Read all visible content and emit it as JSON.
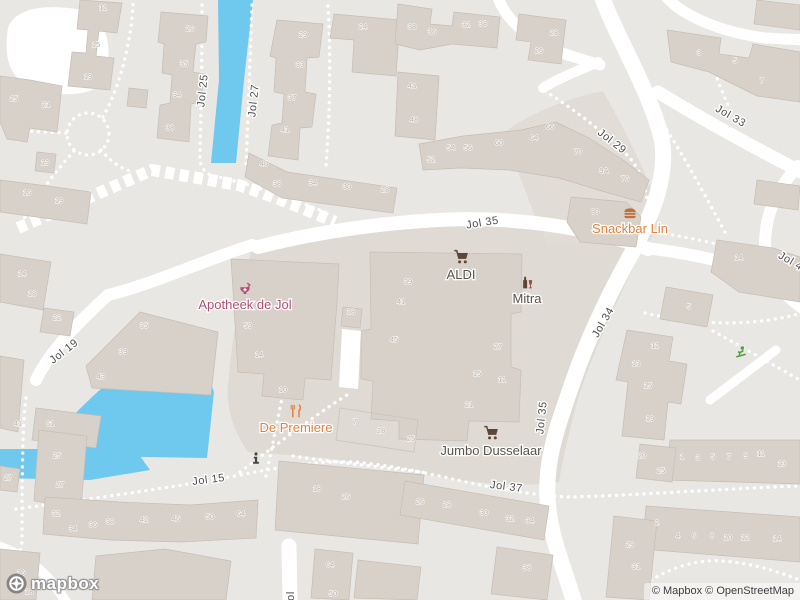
{
  "map": {
    "colors": {
      "land": "#e9e7e4",
      "paved_zone": "#dfdbd4",
      "building": "#d8d1c9",
      "water": "#6fc8ee",
      "road": "#ffffff",
      "street_label": "#4c4c4c",
      "house_number": "#b1aba3",
      "poi_orange": "#e0813e",
      "poi_maroon": "#b04f73",
      "poi_dark": "#58524d",
      "poi_brown": "#6d4b38",
      "playground_green": "#4ba13e"
    },
    "street_labels": [
      {
        "text": "Jol 25",
        "x": 206,
        "y": 91,
        "rotate": -84
      },
      {
        "text": "Jol 27",
        "x": 257,
        "y": 101,
        "rotate": -84
      },
      {
        "text": "Jol 29",
        "x": 610,
        "y": 144,
        "rotate": 38
      },
      {
        "text": "Jol 33",
        "x": 729,
        "y": 119,
        "rotate": 30
      },
      {
        "text": "Jol 35",
        "x": 483,
        "y": 226,
        "rotate": -9
      },
      {
        "text": "Jol 4",
        "x": 789,
        "y": 264,
        "rotate": 30
      },
      {
        "text": "Jol 34",
        "x": 606,
        "y": 324,
        "rotate": -60
      },
      {
        "text": "Jol 19",
        "x": 66,
        "y": 354,
        "rotate": -38
      },
      {
        "text": "Jol 35",
        "x": 545,
        "y": 418,
        "rotate": -84
      },
      {
        "text": "Jol 15",
        "x": 209,
        "y": 483,
        "rotate": -7
      },
      {
        "text": "Jol 37",
        "x": 506,
        "y": 490,
        "rotate": 7
      },
      {
        "text": "Jol",
        "x": 294,
        "y": 599,
        "rotate": -90
      }
    ],
    "pois": [
      {
        "label": "Apotheek de Jol",
        "icon": "pharmacy-icon",
        "x": 245,
        "y": 289,
        "label_y": 309,
        "color": "#b04f73",
        "size": 14
      },
      {
        "label": "Snackbar Lin",
        "icon": "burger-icon",
        "x": 630,
        "y": 213,
        "label_y": 233,
        "color": "#e0813e",
        "icon_color": "#c0703a",
        "size": 15
      },
      {
        "label": "ALDI",
        "icon": "cart-icon",
        "x": 461,
        "y": 257,
        "label_y": 279,
        "color": "#58524d",
        "icon_color": "#5d4537",
        "size": 16
      },
      {
        "label": "Mitra",
        "icon": "drinks-icon",
        "x": 527,
        "y": 283,
        "label_y": 303,
        "color": "#58524d",
        "icon_color": "#5d4537",
        "size": 15
      },
      {
        "label": "De Premiere",
        "icon": "restaurant-icon",
        "x": 296,
        "y": 411,
        "label_y": 432,
        "color": "#e0813e",
        "size": 15
      },
      {
        "label": "Jumbo Dusselaar",
        "icon": "cart-icon",
        "x": 491,
        "y": 433,
        "label_y": 455,
        "color": "#58524d",
        "icon_color": "#5d4537",
        "size": 16
      },
      {
        "label": "",
        "icon": "info-icon",
        "x": 256,
        "y": 458,
        "label_y": 0,
        "color": "#454545",
        "size": 13
      },
      {
        "label": "",
        "icon": "playground-icon",
        "x": 741,
        "y": 352,
        "label_y": 0,
        "color": "#4ba13e",
        "size": 14
      }
    ],
    "house_numbers": [
      {
        "t": "11",
        "x": 103,
        "y": 10
      },
      {
        "t": "15",
        "x": 96,
        "y": 47
      },
      {
        "t": "19",
        "x": 88,
        "y": 79
      },
      {
        "t": "25",
        "x": 14,
        "y": 101
      },
      {
        "t": "21",
        "x": 46,
        "y": 107
      },
      {
        "t": "13",
        "x": 45,
        "y": 165
      },
      {
        "t": "26",
        "x": 190,
        "y": 31
      },
      {
        "t": "35",
        "x": 184,
        "y": 66
      },
      {
        "t": "34",
        "x": 177,
        "y": 97
      },
      {
        "t": "38",
        "x": 170,
        "y": 130
      },
      {
        "t": "29",
        "x": 303,
        "y": 37
      },
      {
        "t": "33",
        "x": 300,
        "y": 67
      },
      {
        "t": "37",
        "x": 292,
        "y": 100
      },
      {
        "t": "41",
        "x": 285,
        "y": 132
      },
      {
        "t": "40",
        "x": 264,
        "y": 166
      },
      {
        "t": "38",
        "x": 277,
        "y": 186
      },
      {
        "t": "34",
        "x": 313,
        "y": 185
      },
      {
        "t": "30",
        "x": 347,
        "y": 189
      },
      {
        "t": "28",
        "x": 385,
        "y": 192
      },
      {
        "t": "24",
        "x": 363,
        "y": 29
      },
      {
        "t": "16",
        "x": 27,
        "y": 195
      },
      {
        "t": "19",
        "x": 59,
        "y": 203
      },
      {
        "t": "14",
        "x": 22,
        "y": 276
      },
      {
        "t": "18",
        "x": 32,
        "y": 296
      },
      {
        "t": "38",
        "x": 412,
        "y": 29
      },
      {
        "t": "36",
        "x": 432,
        "y": 34
      },
      {
        "t": "32",
        "x": 466,
        "y": 27
      },
      {
        "t": "38",
        "x": 483,
        "y": 26
      },
      {
        "t": "28",
        "x": 554,
        "y": 35
      },
      {
        "t": "26",
        "x": 539,
        "y": 53
      },
      {
        "t": "3",
        "x": 699,
        "y": 55
      },
      {
        "t": "5",
        "x": 735,
        "y": 63
      },
      {
        "t": "7",
        "x": 762,
        "y": 83
      },
      {
        "t": "4a",
        "x": 412,
        "y": 88
      },
      {
        "t": "48",
        "x": 414,
        "y": 122
      },
      {
        "t": "54",
        "x": 451,
        "y": 150
      },
      {
        "t": "52",
        "x": 431,
        "y": 162
      },
      {
        "t": "56",
        "x": 468,
        "y": 150
      },
      {
        "t": "60",
        "x": 499,
        "y": 145
      },
      {
        "t": "64",
        "x": 534,
        "y": 140
      },
      {
        "t": "66",
        "x": 550,
        "y": 129
      },
      {
        "t": "70",
        "x": 578,
        "y": 154
      },
      {
        "t": "9A",
        "x": 604,
        "y": 173
      },
      {
        "t": "76",
        "x": 625,
        "y": 181
      },
      {
        "t": "80",
        "x": 595,
        "y": 214
      },
      {
        "t": "14",
        "x": 739,
        "y": 260
      },
      {
        "t": "59",
        "x": 248,
        "y": 328
      },
      {
        "t": "14",
        "x": 259,
        "y": 357
      },
      {
        "t": "10",
        "x": 283,
        "y": 392
      },
      {
        "t": "18",
        "x": 351,
        "y": 314
      },
      {
        "t": "39",
        "x": 408,
        "y": 284
      },
      {
        "t": "41",
        "x": 401,
        "y": 304
      },
      {
        "t": "45",
        "x": 394,
        "y": 342
      },
      {
        "t": "27",
        "x": 498,
        "y": 349
      },
      {
        "t": "15",
        "x": 477,
        "y": 376
      },
      {
        "t": "11",
        "x": 502,
        "y": 382
      },
      {
        "t": "21",
        "x": 469,
        "y": 407
      },
      {
        "t": "7",
        "x": 355,
        "y": 424
      },
      {
        "t": "28",
        "x": 381,
        "y": 433
      },
      {
        "t": "25",
        "x": 411,
        "y": 441
      },
      {
        "t": "22",
        "x": 57,
        "y": 320
      },
      {
        "t": "35",
        "x": 144,
        "y": 328
      },
      {
        "t": "39",
        "x": 123,
        "y": 354
      },
      {
        "t": "43",
        "x": 101,
        "y": 379
      },
      {
        "t": "41",
        "x": 18,
        "y": 426
      },
      {
        "t": "61",
        "x": 50,
        "y": 426
      },
      {
        "t": "25",
        "x": 57,
        "y": 458
      },
      {
        "t": "27",
        "x": 60,
        "y": 487
      },
      {
        "t": "27",
        "x": 8,
        "y": 480
      },
      {
        "t": "32",
        "x": 56,
        "y": 516
      },
      {
        "t": "34",
        "x": 73,
        "y": 531
      },
      {
        "t": "36",
        "x": 93,
        "y": 527
      },
      {
        "t": "38",
        "x": 110,
        "y": 524
      },
      {
        "t": "42",
        "x": 144,
        "y": 522
      },
      {
        "t": "46",
        "x": 176,
        "y": 521
      },
      {
        "t": "50",
        "x": 210,
        "y": 519
      },
      {
        "t": "64",
        "x": 241,
        "y": 516
      },
      {
        "t": "16",
        "x": 21,
        "y": 575
      },
      {
        "t": "18",
        "x": 29,
        "y": 594
      },
      {
        "t": "18",
        "x": 317,
        "y": 491
      },
      {
        "t": "26",
        "x": 346,
        "y": 499
      },
      {
        "t": "64",
        "x": 330,
        "y": 567
      },
      {
        "t": "50",
        "x": 333,
        "y": 596
      },
      {
        "t": "26",
        "x": 420,
        "y": 504
      },
      {
        "t": "28",
        "x": 447,
        "y": 507
      },
      {
        "t": "30",
        "x": 484,
        "y": 515
      },
      {
        "t": "32",
        "x": 510,
        "y": 521
      },
      {
        "t": "34",
        "x": 530,
        "y": 523
      },
      {
        "t": "38",
        "x": 527,
        "y": 570
      },
      {
        "t": "11",
        "x": 655,
        "y": 348
      },
      {
        "t": "13",
        "x": 636,
        "y": 366
      },
      {
        "t": "15",
        "x": 648,
        "y": 388
      },
      {
        "t": "19",
        "x": 650,
        "y": 421
      },
      {
        "t": "20",
        "x": 642,
        "y": 458
      },
      {
        "t": "25",
        "x": 661,
        "y": 473
      },
      {
        "t": "1",
        "x": 682,
        "y": 459
      },
      {
        "t": "3",
        "x": 698,
        "y": 460
      },
      {
        "t": "5",
        "x": 713,
        "y": 459
      },
      {
        "t": "7",
        "x": 729,
        "y": 459
      },
      {
        "t": "9",
        "x": 746,
        "y": 458
      },
      {
        "t": "11",
        "x": 761,
        "y": 456
      },
      {
        "t": "13",
        "x": 782,
        "y": 466
      },
      {
        "t": "2",
        "x": 657,
        "y": 525
      },
      {
        "t": "4",
        "x": 678,
        "y": 538
      },
      {
        "t": "6",
        "x": 694,
        "y": 538
      },
      {
        "t": "8",
        "x": 712,
        "y": 538
      },
      {
        "t": "10",
        "x": 728,
        "y": 540
      },
      {
        "t": "12",
        "x": 745,
        "y": 540
      },
      {
        "t": "14",
        "x": 777,
        "y": 541
      },
      {
        "t": "29",
        "x": 630,
        "y": 547
      },
      {
        "t": "31",
        "x": 636,
        "y": 569
      },
      {
        "t": "5",
        "x": 689,
        "y": 309
      }
    ]
  },
  "branding": {
    "logo_text": "mapbox"
  },
  "attribution": {
    "text": "© Mapbox © OpenStreetMap"
  }
}
